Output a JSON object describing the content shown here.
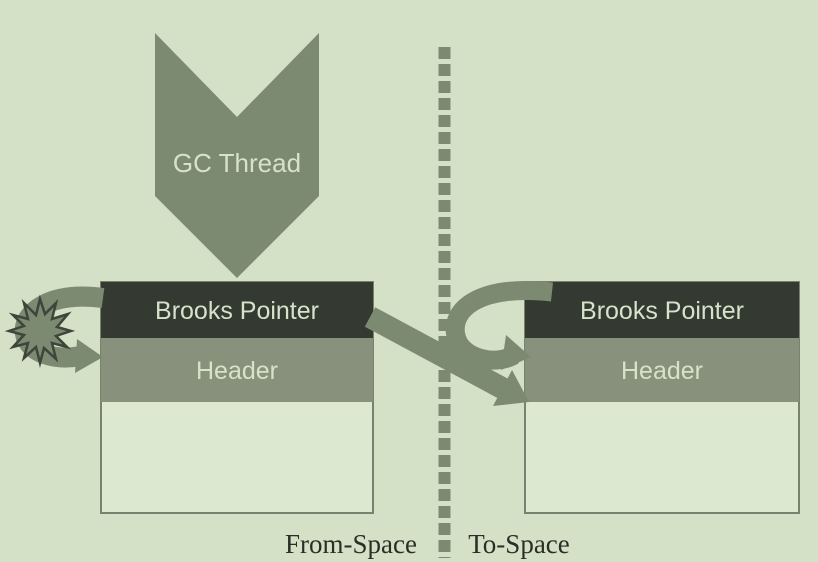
{
  "gc_thread": {
    "label": "GC Thread"
  },
  "from_space": {
    "region_label": "From-Space",
    "object": {
      "pointer_label": "Brooks Pointer",
      "header_label": "Header"
    }
  },
  "to_space": {
    "region_label": "To-Space",
    "object": {
      "pointer_label": "Brooks Pointer",
      "header_label": "Header"
    }
  },
  "colors": {
    "background": "#d4e1c6",
    "object_body": "#dde8d1",
    "object_border": "#78836f",
    "pointer_bar": "#343931",
    "header_bar": "#87917b",
    "arrow": "#7c8a72",
    "bar_text": "#d6e2c9",
    "label_text": "#2a2e25",
    "burst_outline": "#3e453a"
  }
}
